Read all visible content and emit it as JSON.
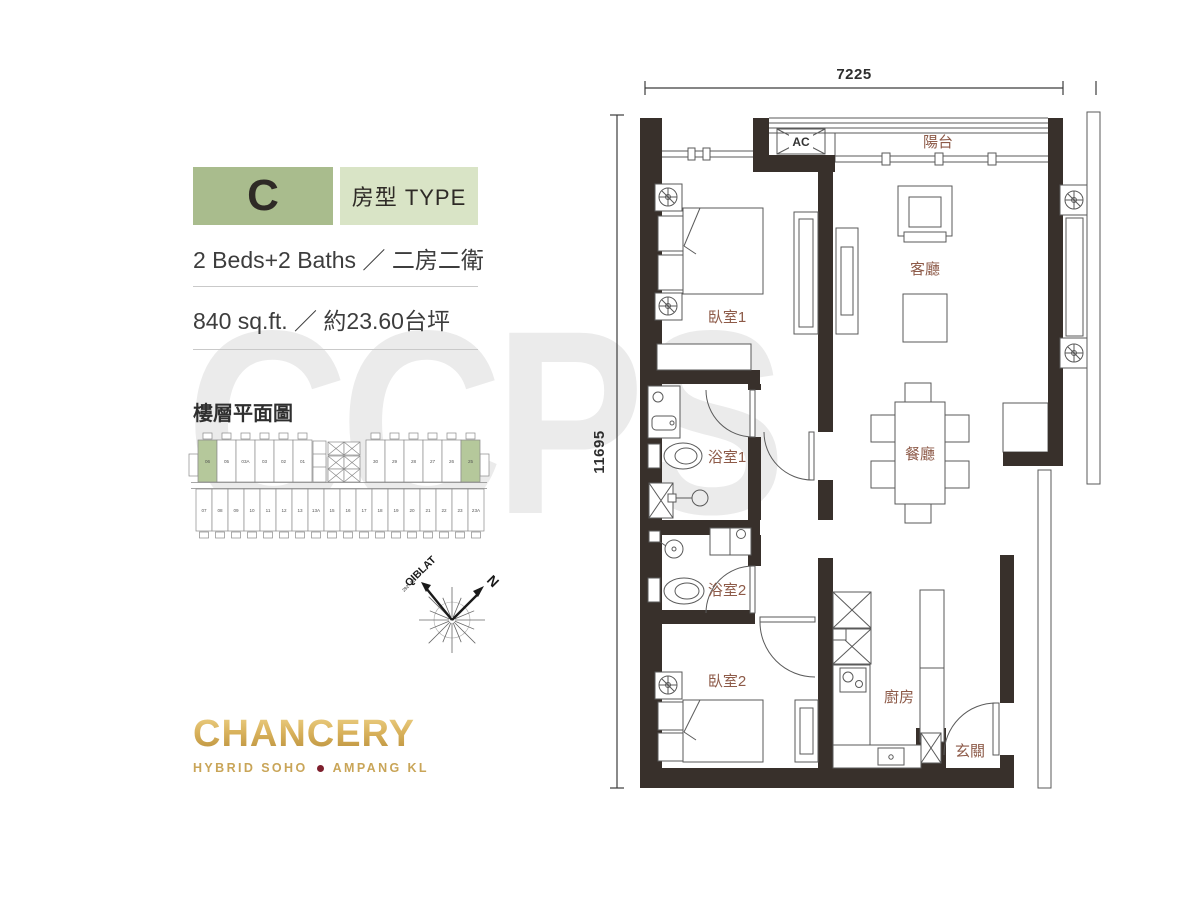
{
  "unit": {
    "type_letter": "C",
    "type_label": "房型 TYPE",
    "beds_baths": "2 Beds+2 Baths ／ 二房二衛",
    "area": "840 sq.ft. ／ 約23.60台坪"
  },
  "key_plan": {
    "title": "樓層平面圖",
    "top_units": [
      "06",
      "05",
      "03A",
      "03",
      "02",
      "01",
      "30",
      "29",
      "28",
      "27",
      "26",
      "25"
    ],
    "bottom_units": [
      "07",
      "08",
      "09",
      "10",
      "11",
      "12",
      "13",
      "13A",
      "15",
      "16",
      "17",
      "18",
      "19",
      "20",
      "21",
      "22",
      "23",
      "23A"
    ],
    "highlighted": [
      "06",
      "25"
    ],
    "highlight_color": "#b5c89b"
  },
  "compass": {
    "north": "N",
    "qiblat": "QIBLAT",
    "qiblat_bearing": "292° 32'"
  },
  "logo": {
    "brand": "CHANCERY",
    "tagline_left": "HYBRID SOHO",
    "tagline_right": "AMPANG KL",
    "gold_color": "#c9a558",
    "dot_color": "#7e1f2d"
  },
  "watermark": "CCPS",
  "plan": {
    "dim_width": "7225",
    "dim_height": "11695",
    "ac_label": "AC",
    "wall_color": "#38302b",
    "room_label_color": "#8d5a48",
    "rooms": {
      "bedroom1": "臥室1",
      "living": "客廳",
      "bath1": "浴室1",
      "dining": "餐廳",
      "bath2": "浴室2",
      "bedroom2": "臥室2",
      "kitchen": "廚房",
      "foyer": "玄關",
      "balcony": "陽台"
    }
  }
}
